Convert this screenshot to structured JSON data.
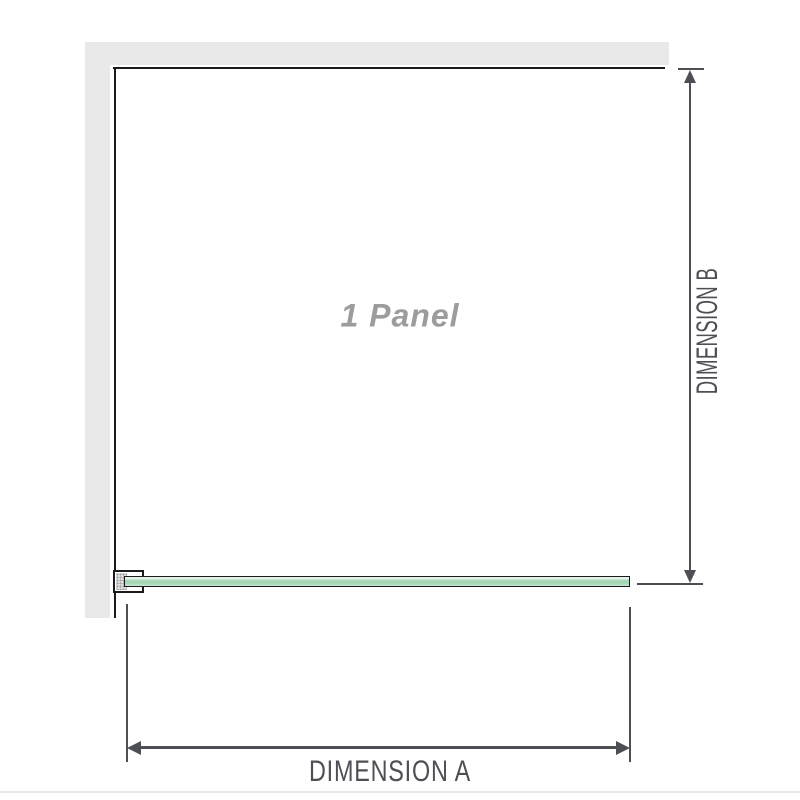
{
  "diagram": {
    "panel_label": "1 Panel",
    "dimension_a_label": "DIMENSION A",
    "dimension_b_label": "DIMENSION B"
  },
  "colors": {
    "wall": "#e9e9e9",
    "ink": "#1a1a1a",
    "dim": "#4d4f54",
    "label": "#9c9c9c",
    "glass-light": "#e2f2e8",
    "glass-mid": "#a5d6b5",
    "glass-soft": "#c8e7d3",
    "rule": "#eae7e1"
  }
}
